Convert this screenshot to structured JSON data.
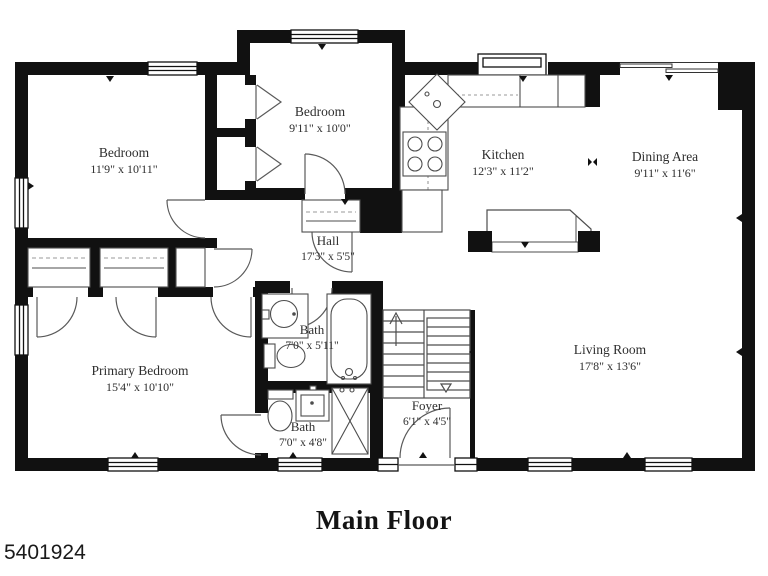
{
  "meta": {
    "floor_title": "Main Floor",
    "photo_id": "5401924"
  },
  "rooms": [
    {
      "name": "Bedroom",
      "dimensions": "11'9\" x 10'11\""
    },
    {
      "name": "Bedroom",
      "dimensions": "9'11\" x 10'0\""
    },
    {
      "name": "Kitchen",
      "dimensions": "12'3\" x 11'2\""
    },
    {
      "name": "Dining Area",
      "dimensions": "9'11\" x 11'6\""
    },
    {
      "name": "Hall",
      "dimensions": "17'3\" x 5'5\""
    },
    {
      "name": "Bath",
      "dimensions": "7'0\" x 5'11\""
    },
    {
      "name": "Primary Bedroom",
      "dimensions": "15'4\" x 10'10\""
    },
    {
      "name": "Bath",
      "dimensions": "7'0\" x 4'8\""
    },
    {
      "name": "Foyer",
      "dimensions": "6'1\" x 4'5\""
    },
    {
      "name": "Living Room",
      "dimensions": "17'8\" x 13'6\""
    }
  ],
  "colors": {
    "wall": "#111111",
    "line": "#4d4d4d",
    "text": "#2e2e2e",
    "background": "#ffffff"
  }
}
